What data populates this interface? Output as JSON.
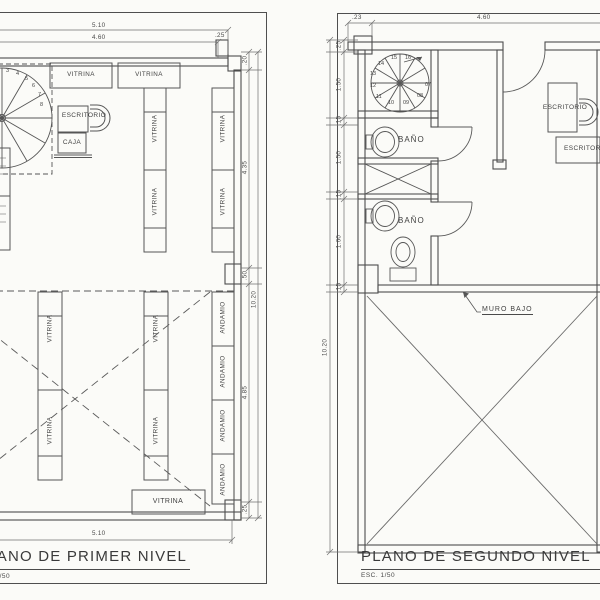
{
  "plan_first": {
    "title": "PLANO DE PRIMER NIVEL",
    "scale_label": "ESC. 1/50",
    "dims": {
      "top_total": "5.10",
      "top_inner": "4.60",
      "top_end": ".25",
      "right_wall": ".20",
      "right_upper": "4.35",
      "right_step": ".50",
      "right_lower": "4.85",
      "right_end": ".25",
      "right_total": "10.20",
      "bottom_total": "5.10"
    },
    "labels": {
      "vitrina": "VITRINA",
      "andamio": "ANDAMIO",
      "escritorio": "ESCRITORIO",
      "caja": "CAJA"
    },
    "stair_steps": [
      "2",
      "3",
      "4",
      "5",
      "6",
      "7",
      "8"
    ]
  },
  "plan_second": {
    "title": "PLANO DE SEGUNDO NIVEL",
    "scale_label": "ESC. 1/50",
    "dims": {
      "top_left": ".23",
      "top_inner": "4.60",
      "left_chain": [
        ".25",
        "1.50",
        ".15",
        "1.50",
        ".15",
        "1.60",
        ".15"
      ],
      "left_total": "10.20"
    },
    "labels": {
      "bath": "BAÑO",
      "desk": "ESCRITORIO",
      "low_wall": "MURO BAJO"
    },
    "stair_steps": [
      "07",
      "08",
      "09",
      "10",
      "11",
      "12",
      "13",
      "14",
      "15",
      "16"
    ]
  }
}
